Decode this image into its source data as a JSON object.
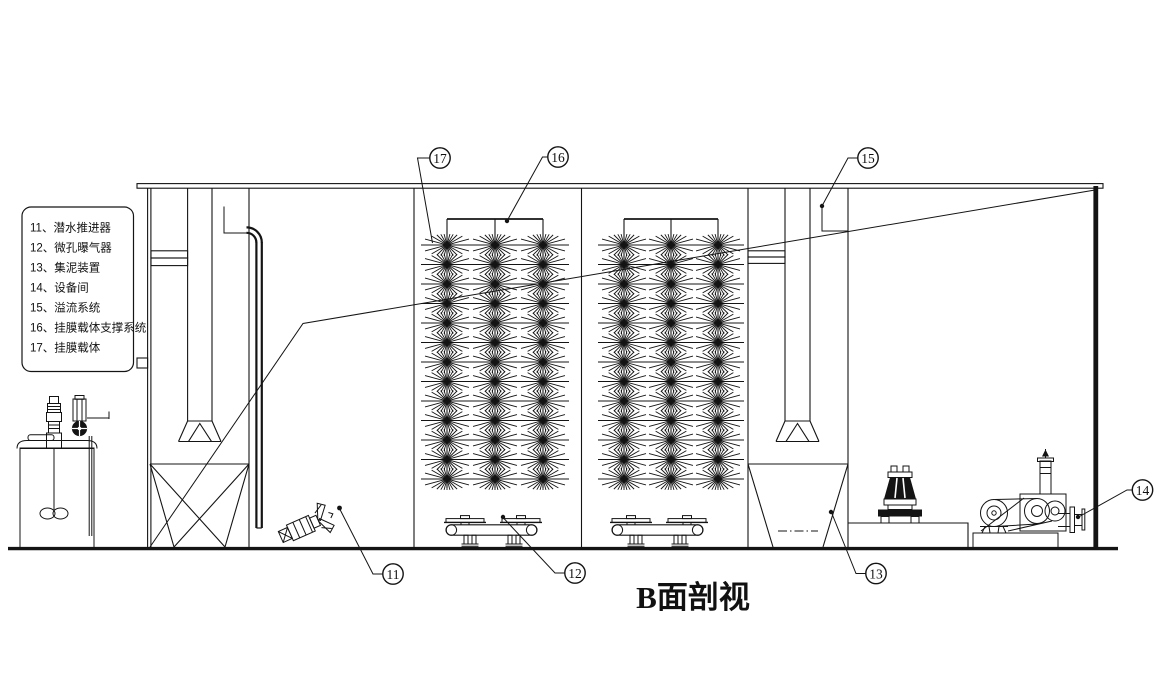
{
  "title": "B面剖视",
  "legend": {
    "items": [
      "11、潜水推进器",
      "12、微孔曝气器",
      "13、集泥装置",
      "14、设备间",
      "15、溢流系统",
      "16、挂膜载体支撑系统",
      "17、挂膜载体"
    ]
  },
  "callouts": [
    {
      "label": "11"
    },
    {
      "label": "12"
    },
    {
      "label": "13"
    },
    {
      "label": "14"
    },
    {
      "label": "15"
    },
    {
      "label": "16"
    },
    {
      "label": "17"
    }
  ],
  "figure": {
    "brush_grid": {
      "assemblies": [
        {
          "rods": [
            447,
            495,
            543
          ]
        },
        {
          "rods": [
            624,
            671,
            718
          ]
        }
      ],
      "frame_top_y": 219,
      "rod_bottom_y": 488,
      "rows": 13,
      "row_start_y": 245,
      "row_spacing": 19.5,
      "star_rx": 26,
      "star_ry": 11
    },
    "aerators": {
      "positions": [
        {
          "x": 446,
          "y": 530
        },
        {
          "x": 612,
          "y": 530
        }
      ]
    }
  }
}
